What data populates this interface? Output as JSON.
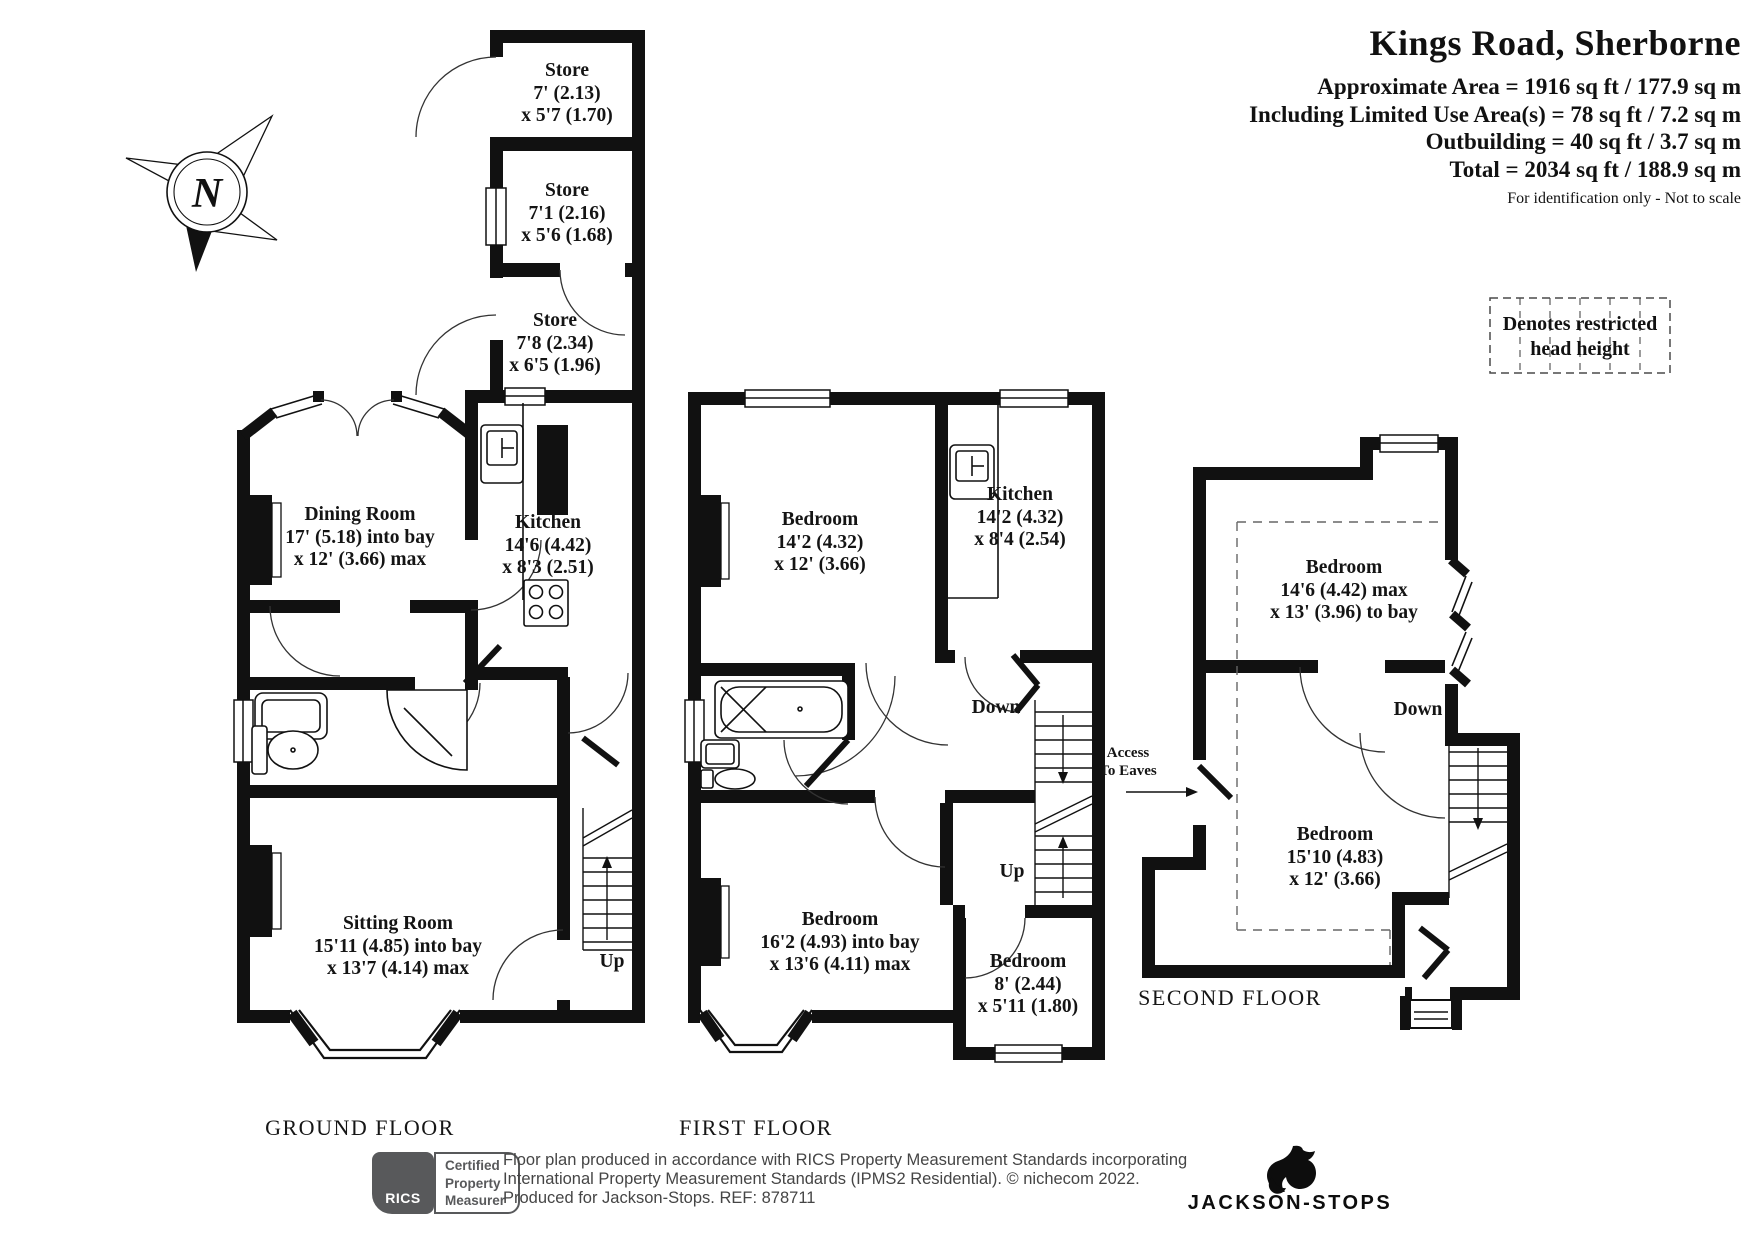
{
  "header": {
    "title": "Kings Road, Sherborne",
    "line1": "Approximate Area = 1916 sq ft / 177.9 sq m",
    "line2": "Including Limited Use Area(s) = 78 sq ft / 7.2 sq m",
    "line3": "Outbuilding = 40 sq ft / 3.7 sq m",
    "line4": "Total = 2034 sq ft / 188.9 sq m",
    "note": "For identification only - Not to scale"
  },
  "legend": {
    "line1": "Denotes restricted",
    "line2": "head height"
  },
  "compass": {
    "n": "N"
  },
  "ground": {
    "floor_label": "GROUND FLOOR",
    "store1": {
      "name": "Store",
      "d1": "7' (2.13)",
      "d2": "x 5'7 (1.70)"
    },
    "store2": {
      "name": "Store",
      "d1": "7'1 (2.16)",
      "d2": "x 5'6 (1.68)"
    },
    "store3": {
      "name": "Store",
      "d1": "7'8 (2.34)",
      "d2": "x 6'5 (1.96)"
    },
    "dining": {
      "name": "Dining Room",
      "d1": "17' (5.18) into bay",
      "d2": "x 12' (3.66) max"
    },
    "kitchen": {
      "name": "Kitchen",
      "d1": "14'6 (4.42)",
      "d2": "x 8'3 (2.51)"
    },
    "sitting": {
      "name": "Sitting Room",
      "d1": "15'11 (4.85) into bay",
      "d2": "x 13'7 (4.14) max"
    },
    "up": "Up"
  },
  "first": {
    "floor_label": "FIRST FLOOR",
    "bedroom1": {
      "name": "Bedroom",
      "d1": "14'2 (4.32)",
      "d2": "x 12' (3.66)"
    },
    "kitchen": {
      "name": "Kitchen",
      "d1": "14'2 (4.32)",
      "d2": "x 8'4 (2.54)"
    },
    "bedroom2": {
      "name": "Bedroom",
      "d1": "16'2 (4.93) into bay",
      "d2": "x 13'6 (4.11) max"
    },
    "bedroom3": {
      "name": "Bedroom",
      "d1": "8' (2.44)",
      "d2": "x 5'11 (1.80)"
    },
    "down": "Down",
    "up": "Up"
  },
  "second": {
    "floor_label": "SECOND FLOOR",
    "bedroom1": {
      "name": "Bedroom",
      "d1": "14'6 (4.42) max",
      "d2": "x 13' (3.96) to bay"
    },
    "bedroom2": {
      "name": "Bedroom",
      "d1": "15'10 (4.83)",
      "d2": "x 12' (3.66)"
    },
    "down": "Down",
    "access1": "Access",
    "access2": "To Eaves"
  },
  "footer": {
    "rics_label": "RICS",
    "badge1": "Certified",
    "badge2": "Property",
    "badge3": "Measurer",
    "line1": "Floor plan produced in accordance with RICS Property Measurement Standards incorporating",
    "line2": "International Property Measurement Standards (IPMS2 Residential).   © nichecom 2022.",
    "line3": "Produced for Jackson-Stops.   REF: 878711",
    "brand": "JACKSON-STOPS"
  },
  "colors": {
    "wall": "#111111",
    "rics_gray": "#58595b"
  }
}
